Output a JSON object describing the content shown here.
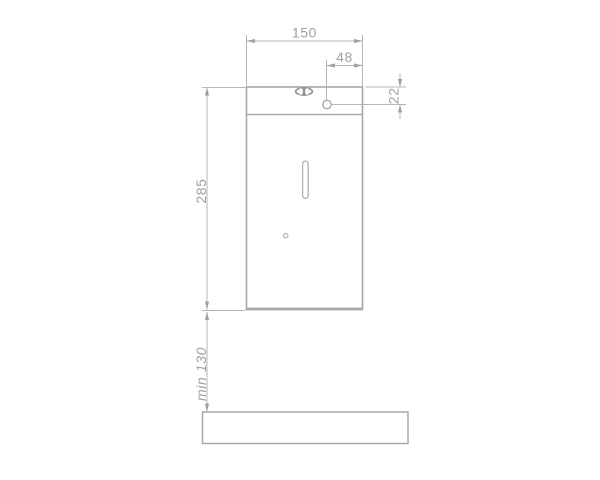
{
  "page": {
    "background_color": "#ffffff",
    "dimension_line_color": "#b2b7bc",
    "outline_color": "#a3a9ae",
    "text_color": "#9ba1a7"
  },
  "drawing": {
    "type": "dimensioned front elevation of wall-mounted soap dispenser above counter",
    "dimensions": {
      "body_width": "150",
      "outlet_offset": "48",
      "outlet_drop": "22",
      "body_height": "285",
      "clearance_below": "min 130"
    }
  }
}
